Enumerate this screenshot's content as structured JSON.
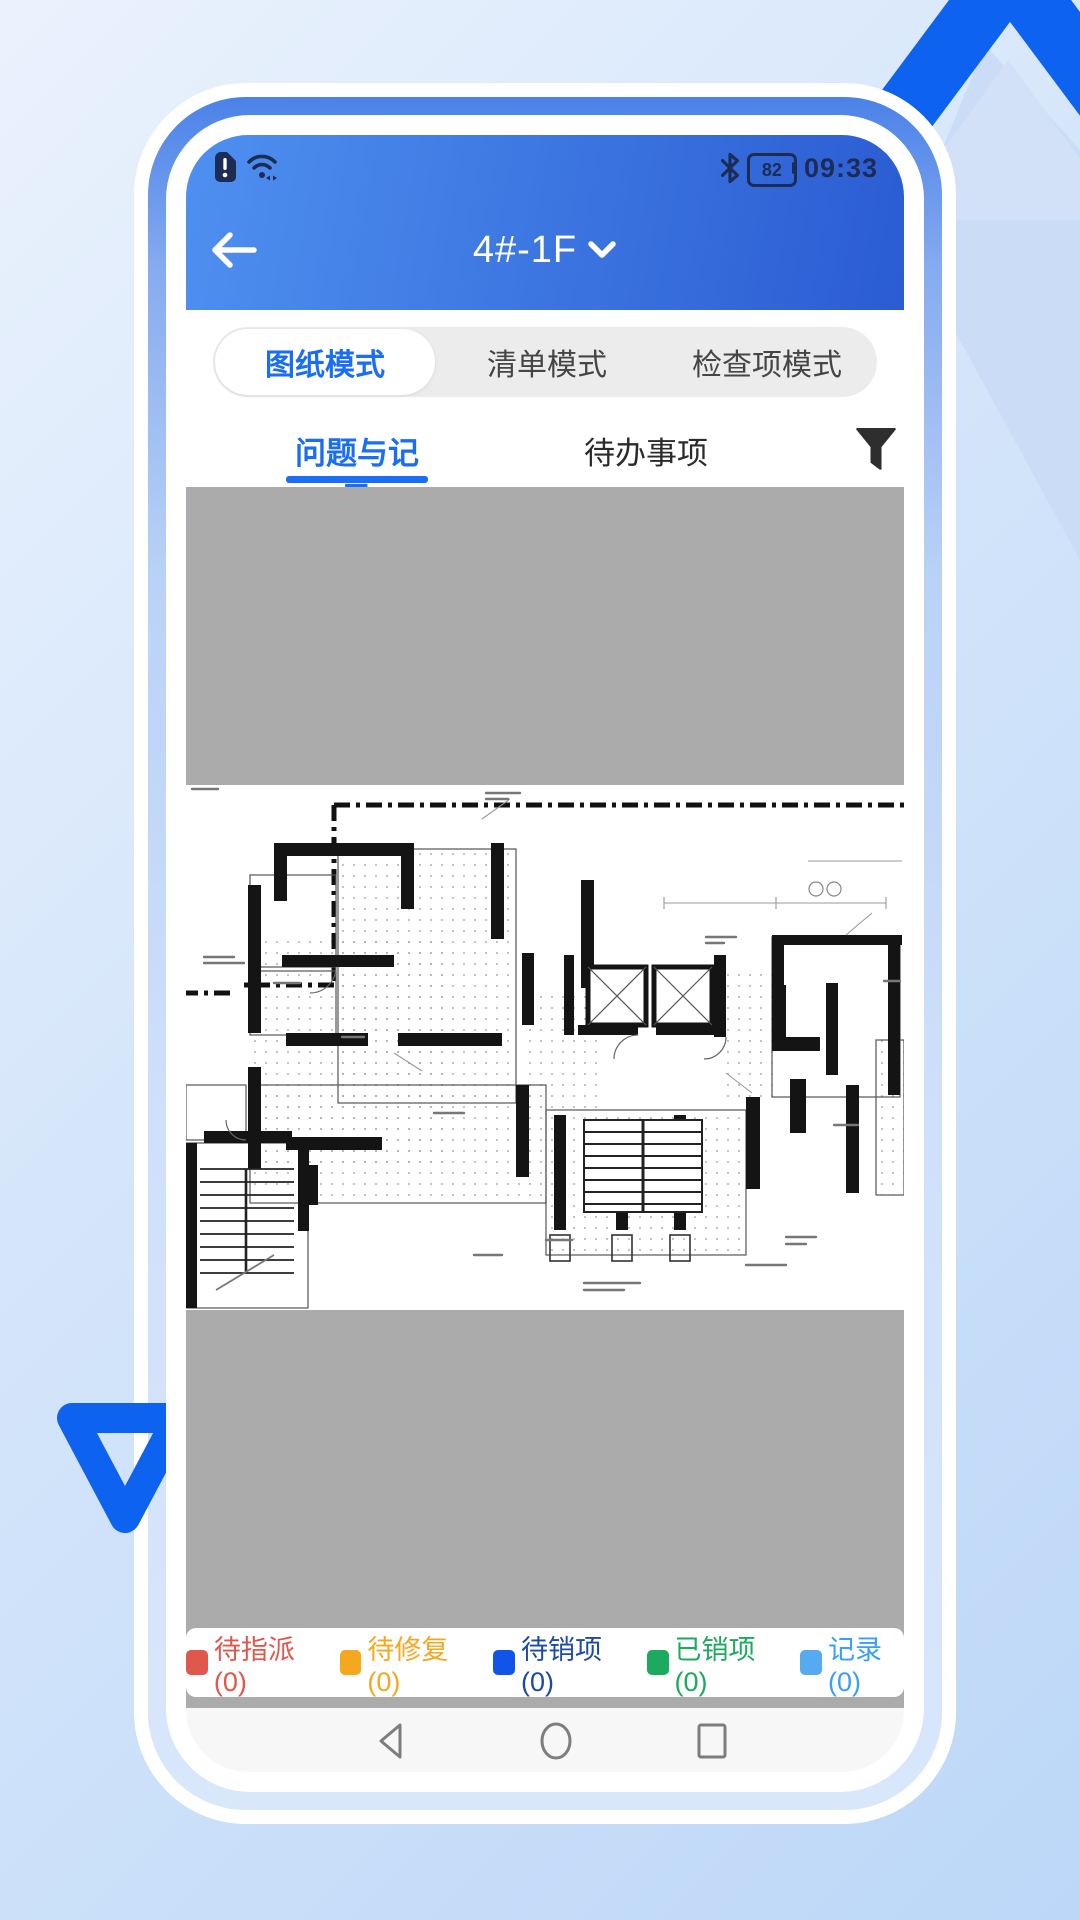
{
  "colors": {
    "accent": "#1a6ef5",
    "header_gradient_start": "#4e90f0",
    "header_gradient_end": "#2b5cd2",
    "viewer_background": "#ababab",
    "decoration_blue": "#0e62f0",
    "status_icon_color": "#1c2c55"
  },
  "status_bar": {
    "time": "09:33",
    "battery_percent": "82",
    "left_icons": [
      "sim-alert-icon",
      "wifi-icon"
    ],
    "right_icons": [
      "bluetooth-icon",
      "battery-icon"
    ]
  },
  "header": {
    "title": "4#-1F",
    "back_icon": "arrow-left",
    "dropdown_icon": "chevron-down"
  },
  "mode_tabs": {
    "items": [
      {
        "label": "图纸模式",
        "active": true
      },
      {
        "label": "清单模式",
        "active": false
      },
      {
        "label": "检查项模式",
        "active": false
      }
    ]
  },
  "sub_tabs": {
    "items": [
      {
        "label": "问题与记录",
        "active": true
      },
      {
        "label": "待办事项",
        "active": false
      }
    ],
    "filter_icon": "funnel-icon"
  },
  "viewer": {
    "content": "floor-plan-drawing"
  },
  "legend": {
    "items": [
      {
        "label": "待指派(0)",
        "color": "#e0574c",
        "text_color": "#e0574c"
      },
      {
        "label": "待修复(0)",
        "color": "#f5a81e",
        "text_color": "#f5a81e"
      },
      {
        "label": "待销项(0)",
        "color": "#1254e8",
        "text_color": "#1d49a8"
      },
      {
        "label": "已销项(0)",
        "color": "#1caa5e",
        "text_color": "#1caa5e"
      },
      {
        "label": "记录(0)",
        "color": "#56aaf0",
        "text_color": "#38a0f5"
      }
    ]
  },
  "navigation": {
    "items": [
      "back",
      "home",
      "recents"
    ]
  }
}
